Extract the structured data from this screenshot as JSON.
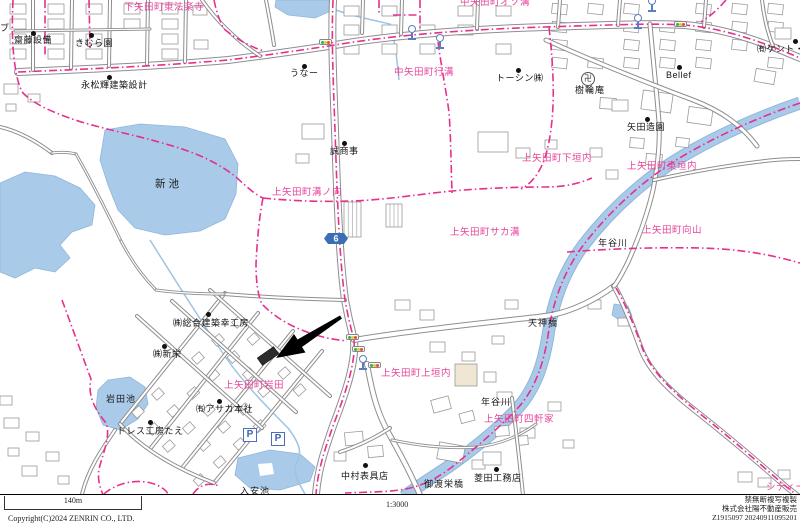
{
  "map": {
    "area_labels": [
      {
        "text": "下矢田町東法楽寺",
        "x": 124,
        "y": 3
      },
      {
        "text": "中矢田町オソ溝",
        "x": 460,
        "y": -2
      },
      {
        "text": "中矢田町行溝",
        "x": 394,
        "y": 68
      },
      {
        "text": "上矢田町溝ノ向",
        "x": 272,
        "y": 188
      },
      {
        "text": "上矢田町下垣内",
        "x": 522,
        "y": 154
      },
      {
        "text": "上矢田町東垣内",
        "x": 627,
        "y": 162
      },
      {
        "text": "上矢田町サカ溝",
        "x": 450,
        "y": 228
      },
      {
        "text": "上矢田町向山",
        "x": 642,
        "y": 226
      },
      {
        "text": "上矢田町岩田",
        "x": 224,
        "y": 381
      },
      {
        "text": "上矢田町上垣内",
        "x": 381,
        "y": 369
      },
      {
        "text": "上矢田町四軒家",
        "x": 484,
        "y": 415
      },
      {
        "text": "シティー",
        "x": 766,
        "y": 483
      }
    ],
    "poi_labels": [
      {
        "text": "齋藤設備",
        "x": 14,
        "y": 36,
        "dx": 31,
        "dy": 31
      },
      {
        "text": "きむら園",
        "x": 75,
        "y": 39,
        "dx": 89,
        "dy": 33
      },
      {
        "text": "永松輝建築設計",
        "x": 81,
        "y": 81,
        "dx": 107,
        "dy": 75
      },
      {
        "text": "うなー",
        "x": 290,
        "y": 69,
        "dx": 302,
        "dy": 64
      },
      {
        "text": "誠商事",
        "x": 330,
        "y": 147,
        "dx": 342,
        "dy": 141
      },
      {
        "text": "トーシン㈱",
        "x": 496,
        "y": 74,
        "dx": 516,
        "dy": 68
      },
      {
        "text": "Bellef",
        "x": 666,
        "y": 71,
        "dx": 677,
        "dy": 65
      },
      {
        "text": "㈲ケント・ハ",
        "x": 757,
        "y": 45,
        "dx": 793,
        "dy": 39
      },
      {
        "text": "矢田造園",
        "x": 627,
        "y": 123,
        "dx": 645,
        "dy": 117
      },
      {
        "text": "㈱総合建築幸工房",
        "x": 173,
        "y": 319,
        "dx": 206,
        "dy": 312
      },
      {
        "text": "㈱新栄",
        "x": 153,
        "y": 350,
        "dx": 162,
        "dy": 344
      },
      {
        "text": "㈲アサカ本社",
        "x": 196,
        "y": 405,
        "dx": 217,
        "dy": 399
      },
      {
        "text": "ドレス工房たえ",
        "x": 117,
        "y": 427,
        "dx": 148,
        "dy": 420
      },
      {
        "text": "中村表具店",
        "x": 341,
        "y": 472,
        "dx": 363,
        "dy": 463
      },
      {
        "text": "菱田工務店",
        "x": 474,
        "y": 474,
        "dx": 494,
        "dy": 467
      }
    ],
    "place_labels": [
      {
        "text": "新池",
        "x": 155,
        "y": 179,
        "big": true
      },
      {
        "text": "岩田池",
        "x": 106,
        "y": 395
      },
      {
        "text": "入安池",
        "x": 240,
        "y": 487
      },
      {
        "text": "年谷川",
        "x": 598,
        "y": 239
      },
      {
        "text": "年谷川",
        "x": 481,
        "y": 398
      },
      {
        "text": "天神橋",
        "x": 528,
        "y": 319
      },
      {
        "text": "御渡栄橋",
        "x": 424,
        "y": 480
      },
      {
        "text": "樹輪庵",
        "x": 575,
        "y": 86
      },
      {
        "text": "ブ",
        "x": 0,
        "y": 24
      }
    ],
    "route_shield": {
      "number": "6",
      "x": 336,
      "y": 239
    },
    "icons": {
      "traffic_lights": [
        {
          "x": 319,
          "y": 39
        },
        {
          "x": 674,
          "y": 21
        },
        {
          "x": 346,
          "y": 334
        },
        {
          "x": 352,
          "y": 346
        },
        {
          "x": 368,
          "y": 362
        }
      ],
      "hydrants": [
        {
          "x": 407,
          "y": 25
        },
        {
          "x": 435,
          "y": 34
        },
        {
          "x": 633,
          "y": 14
        },
        {
          "x": 647,
          "y": -3
        },
        {
          "x": 358,
          "y": 355
        }
      ],
      "parking": [
        {
          "x": 243,
          "y": 428
        },
        {
          "x": 271,
          "y": 432
        }
      ],
      "parking_label": "P",
      "temple": {
        "x": 581,
        "y": 72
      },
      "temple_glyph": "卍"
    }
  },
  "footer": {
    "scale_label": "140m",
    "scale_ratio": "1:3000",
    "copyright": "Copyright(C)2024 ZENRIN CO., LTD.",
    "right_lines": [
      "禁無断複写複製",
      "株式会社陽不動産販売",
      "Z1915097 20240911095201"
    ]
  },
  "colors": {
    "boundary_pink": "#e6308e",
    "label_pink": "#e8459b",
    "water_fill": "#a9cbe9",
    "water_edge": "#8fb6da",
    "road_casing": "#8e8e8e",
    "building_outline": "#9a9a9a",
    "route_shield_blue": "#3d6eb4",
    "icon_blue": "#5b7fbe",
    "target_black": "#2d2d2d"
  }
}
